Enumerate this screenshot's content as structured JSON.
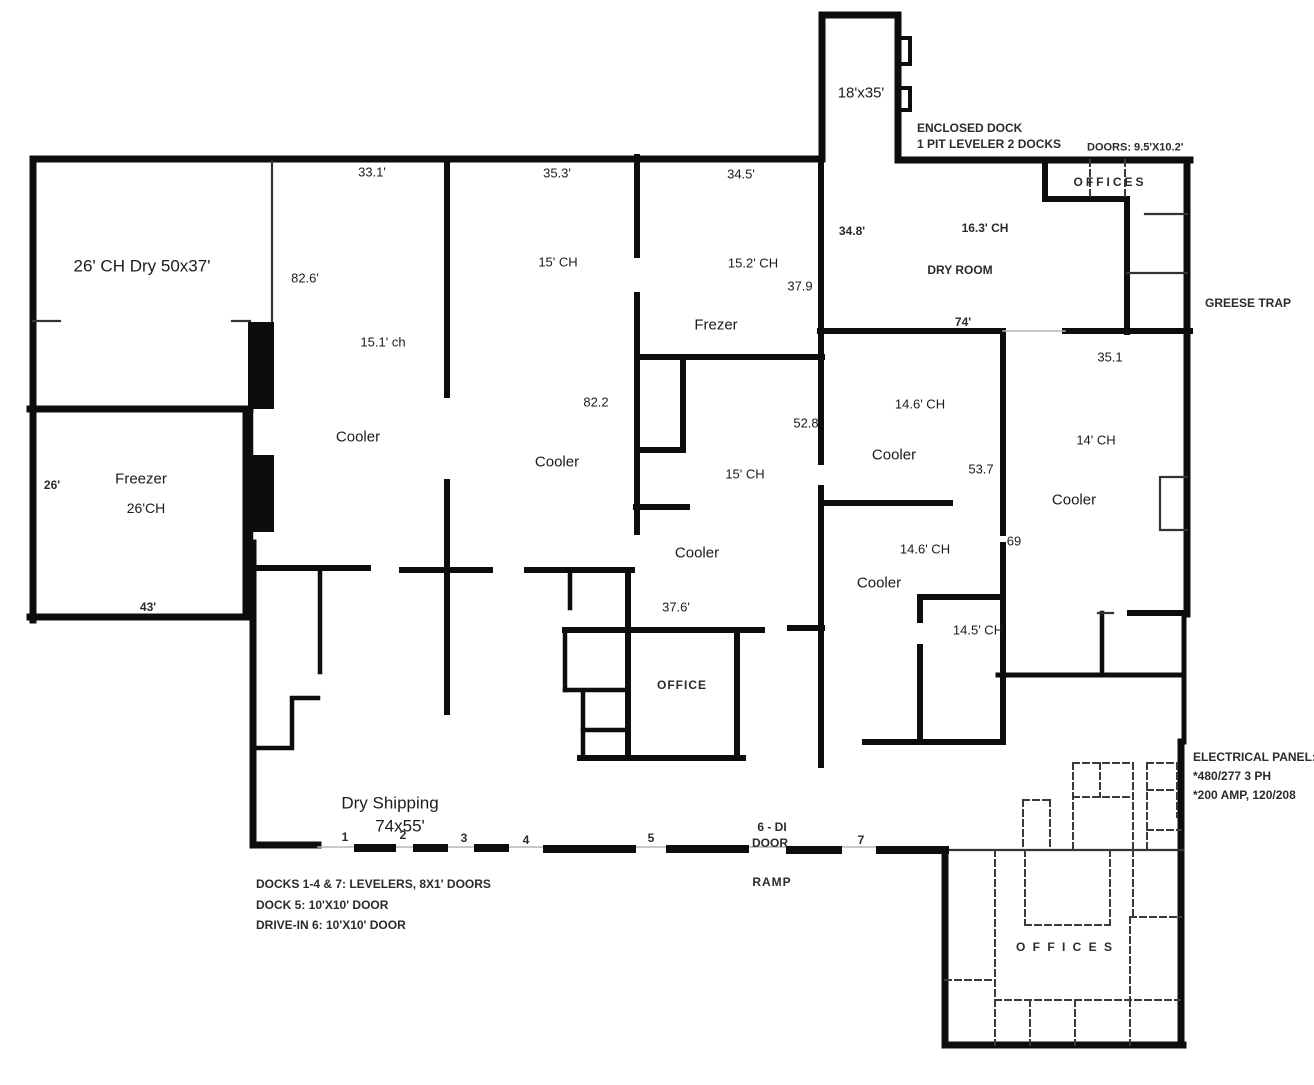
{
  "floor_plan": {
    "title": "Warehouse cold-storage floor plan",
    "colors": {
      "background": "#ffffff",
      "wall": "#0d0d0d",
      "scan_text": "#2b2b2b",
      "clean_text": "#1b1b1b"
    },
    "labels": [
      {
        "name": "room-dry-50x37",
        "text": "26' CH Dry 50x37'",
        "x": 142,
        "y": 266,
        "size": 17,
        "w": 400
      },
      {
        "name": "dim-33-1",
        "text": "33.1'",
        "x": 372,
        "y": 172,
        "size": 13,
        "w": 400
      },
      {
        "name": "dim-82-6",
        "text": "82.6'",
        "x": 305,
        "y": 278,
        "size": 13,
        "w": 400
      },
      {
        "name": "dim-15-1-ch",
        "text": "15.1' ch",
        "x": 383,
        "y": 342,
        "size": 13,
        "w": 400
      },
      {
        "name": "room-cooler-1",
        "text": "Cooler",
        "x": 358,
        "y": 437,
        "size": 15,
        "w": 400
      },
      {
        "name": "dim-35-3",
        "text": "35.3'",
        "x": 557,
        "y": 173,
        "size": 13,
        "w": 400
      },
      {
        "name": "dim-15-ch-1",
        "text": "15' CH",
        "x": 558,
        "y": 262,
        "size": 13,
        "w": 400
      },
      {
        "name": "room-cooler-2",
        "text": "Cooler",
        "x": 557,
        "y": 462,
        "size": 15,
        "w": 400
      },
      {
        "name": "dim-82-2",
        "text": "82.2",
        "x": 596,
        "y": 402,
        "size": 13,
        "w": 400
      },
      {
        "name": "dim-34-5",
        "text": "34.5'",
        "x": 741,
        "y": 174,
        "size": 13,
        "w": 400
      },
      {
        "name": "dim-15-2-ch",
        "text": "15.2' CH",
        "x": 753,
        "y": 263,
        "size": 13,
        "w": 400
      },
      {
        "name": "room-frezer",
        "text": "Frezer",
        "x": 716,
        "y": 325,
        "size": 15,
        "w": 400
      },
      {
        "name": "dim-37-9",
        "text": "37.9",
        "x": 800,
        "y": 286,
        "size": 13,
        "w": 400
      },
      {
        "name": "dim-52-8",
        "text": "52.8",
        "x": 806,
        "y": 423,
        "size": 13,
        "w": 400
      },
      {
        "name": "dim-15-ch-2",
        "text": "15' CH",
        "x": 745,
        "y": 474,
        "size": 13,
        "w": 400
      },
      {
        "name": "room-cooler-3",
        "text": "Cooler",
        "x": 697,
        "y": 553,
        "size": 15,
        "w": 400
      },
      {
        "name": "room-enclosed-dock-size",
        "text": "18'x35'",
        "x": 861,
        "y": 93,
        "size": 15,
        "w": 400
      },
      {
        "name": "note-enclosed-dock-1",
        "text": "ENCLOSED DOCK",
        "x": 917,
        "y": 128,
        "size": 12,
        "w": 700,
        "align": "left"
      },
      {
        "name": "note-enclosed-dock-2",
        "text": "1 PIT LEVELER  2 DOCKS",
        "x": 917,
        "y": 144,
        "size": 12,
        "w": 700,
        "align": "left"
      },
      {
        "name": "note-doors-size",
        "text": "DOORS: 9.5'X10.2'",
        "x": 1087,
        "y": 148,
        "size": 11,
        "w": 700,
        "align": "left"
      },
      {
        "name": "room-offices-top",
        "text": "OFFICES",
        "x": 1110,
        "y": 182,
        "size": 12,
        "w": 700,
        "ls": 3
      },
      {
        "name": "dim-34-8",
        "text": "34.8'",
        "x": 852,
        "y": 231,
        "size": 12,
        "w": 700
      },
      {
        "name": "dim-16-3-ch",
        "text": "16.3' CH",
        "x": 985,
        "y": 228,
        "size": 12,
        "w": 700
      },
      {
        "name": "room-dry-room",
        "text": "DRY ROOM",
        "x": 960,
        "y": 270,
        "size": 12,
        "w": 700
      },
      {
        "name": "dim-74",
        "text": "74'",
        "x": 963,
        "y": 322,
        "size": 12,
        "w": 700
      },
      {
        "name": "note-greese-trap",
        "text": "GREESE TRAP",
        "x": 1205,
        "y": 303,
        "size": 12,
        "w": 700,
        "align": "left"
      },
      {
        "name": "dim-35-1",
        "text": "35.1",
        "x": 1110,
        "y": 357,
        "size": 13,
        "w": 400
      },
      {
        "name": "dim-14-6-ch-a",
        "text": "14.6' CH",
        "x": 920,
        "y": 404,
        "size": 13,
        "w": 400
      },
      {
        "name": "room-cooler-4",
        "text": "Cooler",
        "x": 894,
        "y": 455,
        "size": 15,
        "w": 400
      },
      {
        "name": "dim-53-7",
        "text": "53.7",
        "x": 981,
        "y": 469,
        "size": 13,
        "w": 400
      },
      {
        "name": "dim-14-ch",
        "text": "14' CH",
        "x": 1096,
        "y": 440,
        "size": 13,
        "w": 400
      },
      {
        "name": "room-cooler-5",
        "text": "Cooler",
        "x": 1074,
        "y": 500,
        "size": 15,
        "w": 400
      },
      {
        "name": "dim-69",
        "text": "69",
        "x": 1014,
        "y": 541,
        "size": 13,
        "w": 400
      },
      {
        "name": "dim-14-6-ch-b",
        "text": "14.6' CH",
        "x": 925,
        "y": 549,
        "size": 13,
        "w": 400
      },
      {
        "name": "room-cooler-6",
        "text": "Cooler",
        "x": 879,
        "y": 583,
        "size": 15,
        "w": 400
      },
      {
        "name": "dim-14-5-ch",
        "text": "14.5' CH",
        "x": 978,
        "y": 630,
        "size": 13,
        "w": 400
      },
      {
        "name": "room-freezer",
        "text": "Freezer",
        "x": 141,
        "y": 479,
        "size": 15,
        "w": 400
      },
      {
        "name": "dim-26-ch",
        "text": "26'CH",
        "x": 146,
        "y": 508,
        "size": 14,
        "w": 400
      },
      {
        "name": "dim-26",
        "text": "26'",
        "x": 52,
        "y": 485,
        "size": 12,
        "w": 700
      },
      {
        "name": "dim-43",
        "text": "43'",
        "x": 148,
        "y": 607,
        "size": 12,
        "w": 700
      },
      {
        "name": "dim-37-6",
        "text": "37.6'",
        "x": 676,
        "y": 607,
        "size": 13,
        "w": 400
      },
      {
        "name": "room-office-center",
        "text": "OFFICE",
        "x": 682,
        "y": 685,
        "size": 12,
        "w": 700,
        "ls": 1
      },
      {
        "name": "room-dry-shipping",
        "text": "Dry Shipping",
        "x": 390,
        "y": 803,
        "size": 17,
        "w": 400
      },
      {
        "name": "dim-74x55",
        "text": "74x55'",
        "x": 400,
        "y": 826,
        "size": 17,
        "w": 400
      },
      {
        "name": "dock-num-1",
        "text": "1",
        "x": 345,
        "y": 837,
        "size": 12,
        "w": 700
      },
      {
        "name": "dock-num-2",
        "text": "2",
        "x": 403,
        "y": 835,
        "size": 12,
        "w": 700
      },
      {
        "name": "dock-num-3",
        "text": "3",
        "x": 464,
        "y": 838,
        "size": 12,
        "w": 700
      },
      {
        "name": "dock-num-4",
        "text": "4",
        "x": 526,
        "y": 840,
        "size": 12,
        "w": 700
      },
      {
        "name": "dock-num-5",
        "text": "5",
        "x": 651,
        "y": 838,
        "size": 12,
        "w": 700
      },
      {
        "name": "dock-num-6-line1",
        "text": "6 - DI",
        "x": 772,
        "y": 827,
        "size": 12,
        "w": 700
      },
      {
        "name": "dock-num-6-line2",
        "text": "DOOR",
        "x": 770,
        "y": 843,
        "size": 12,
        "w": 700
      },
      {
        "name": "dock-num-7",
        "text": "7",
        "x": 861,
        "y": 840,
        "size": 12,
        "w": 700
      },
      {
        "name": "note-ramp",
        "text": "RAMP",
        "x": 772,
        "y": 882,
        "size": 12,
        "w": 700,
        "ls": 1
      },
      {
        "name": "note-docks-1",
        "text": "DOCKS 1-4 & 7: LEVELERS, 8X1' DOORS",
        "x": 256,
        "y": 884,
        "size": 12,
        "w": 700,
        "align": "left"
      },
      {
        "name": "note-docks-2",
        "text": "DOCK 5: 10'X10' DOOR",
        "x": 256,
        "y": 905,
        "size": 12,
        "w": 700,
        "align": "left"
      },
      {
        "name": "note-docks-3",
        "text": "DRIVE-IN 6: 10'X10' DOOR",
        "x": 256,
        "y": 925,
        "size": 12,
        "w": 700,
        "align": "left"
      },
      {
        "name": "note-electrical-1",
        "text": "ELECTRICAL PANEL:",
        "x": 1193,
        "y": 757,
        "size": 12,
        "w": 700,
        "align": "left"
      },
      {
        "name": "note-electrical-2",
        "text": "*480/277 3 PH",
        "x": 1193,
        "y": 776,
        "size": 12,
        "w": 700,
        "align": "left"
      },
      {
        "name": "note-electrical-3",
        "text": "*200 AMP, 120/208",
        "x": 1193,
        "y": 795,
        "size": 12,
        "w": 700,
        "align": "left"
      },
      {
        "name": "room-offices-bottom",
        "text": "O F F I C E S",
        "x": 1065,
        "y": 947,
        "size": 12,
        "w": 700,
        "ls": 2
      }
    ]
  }
}
